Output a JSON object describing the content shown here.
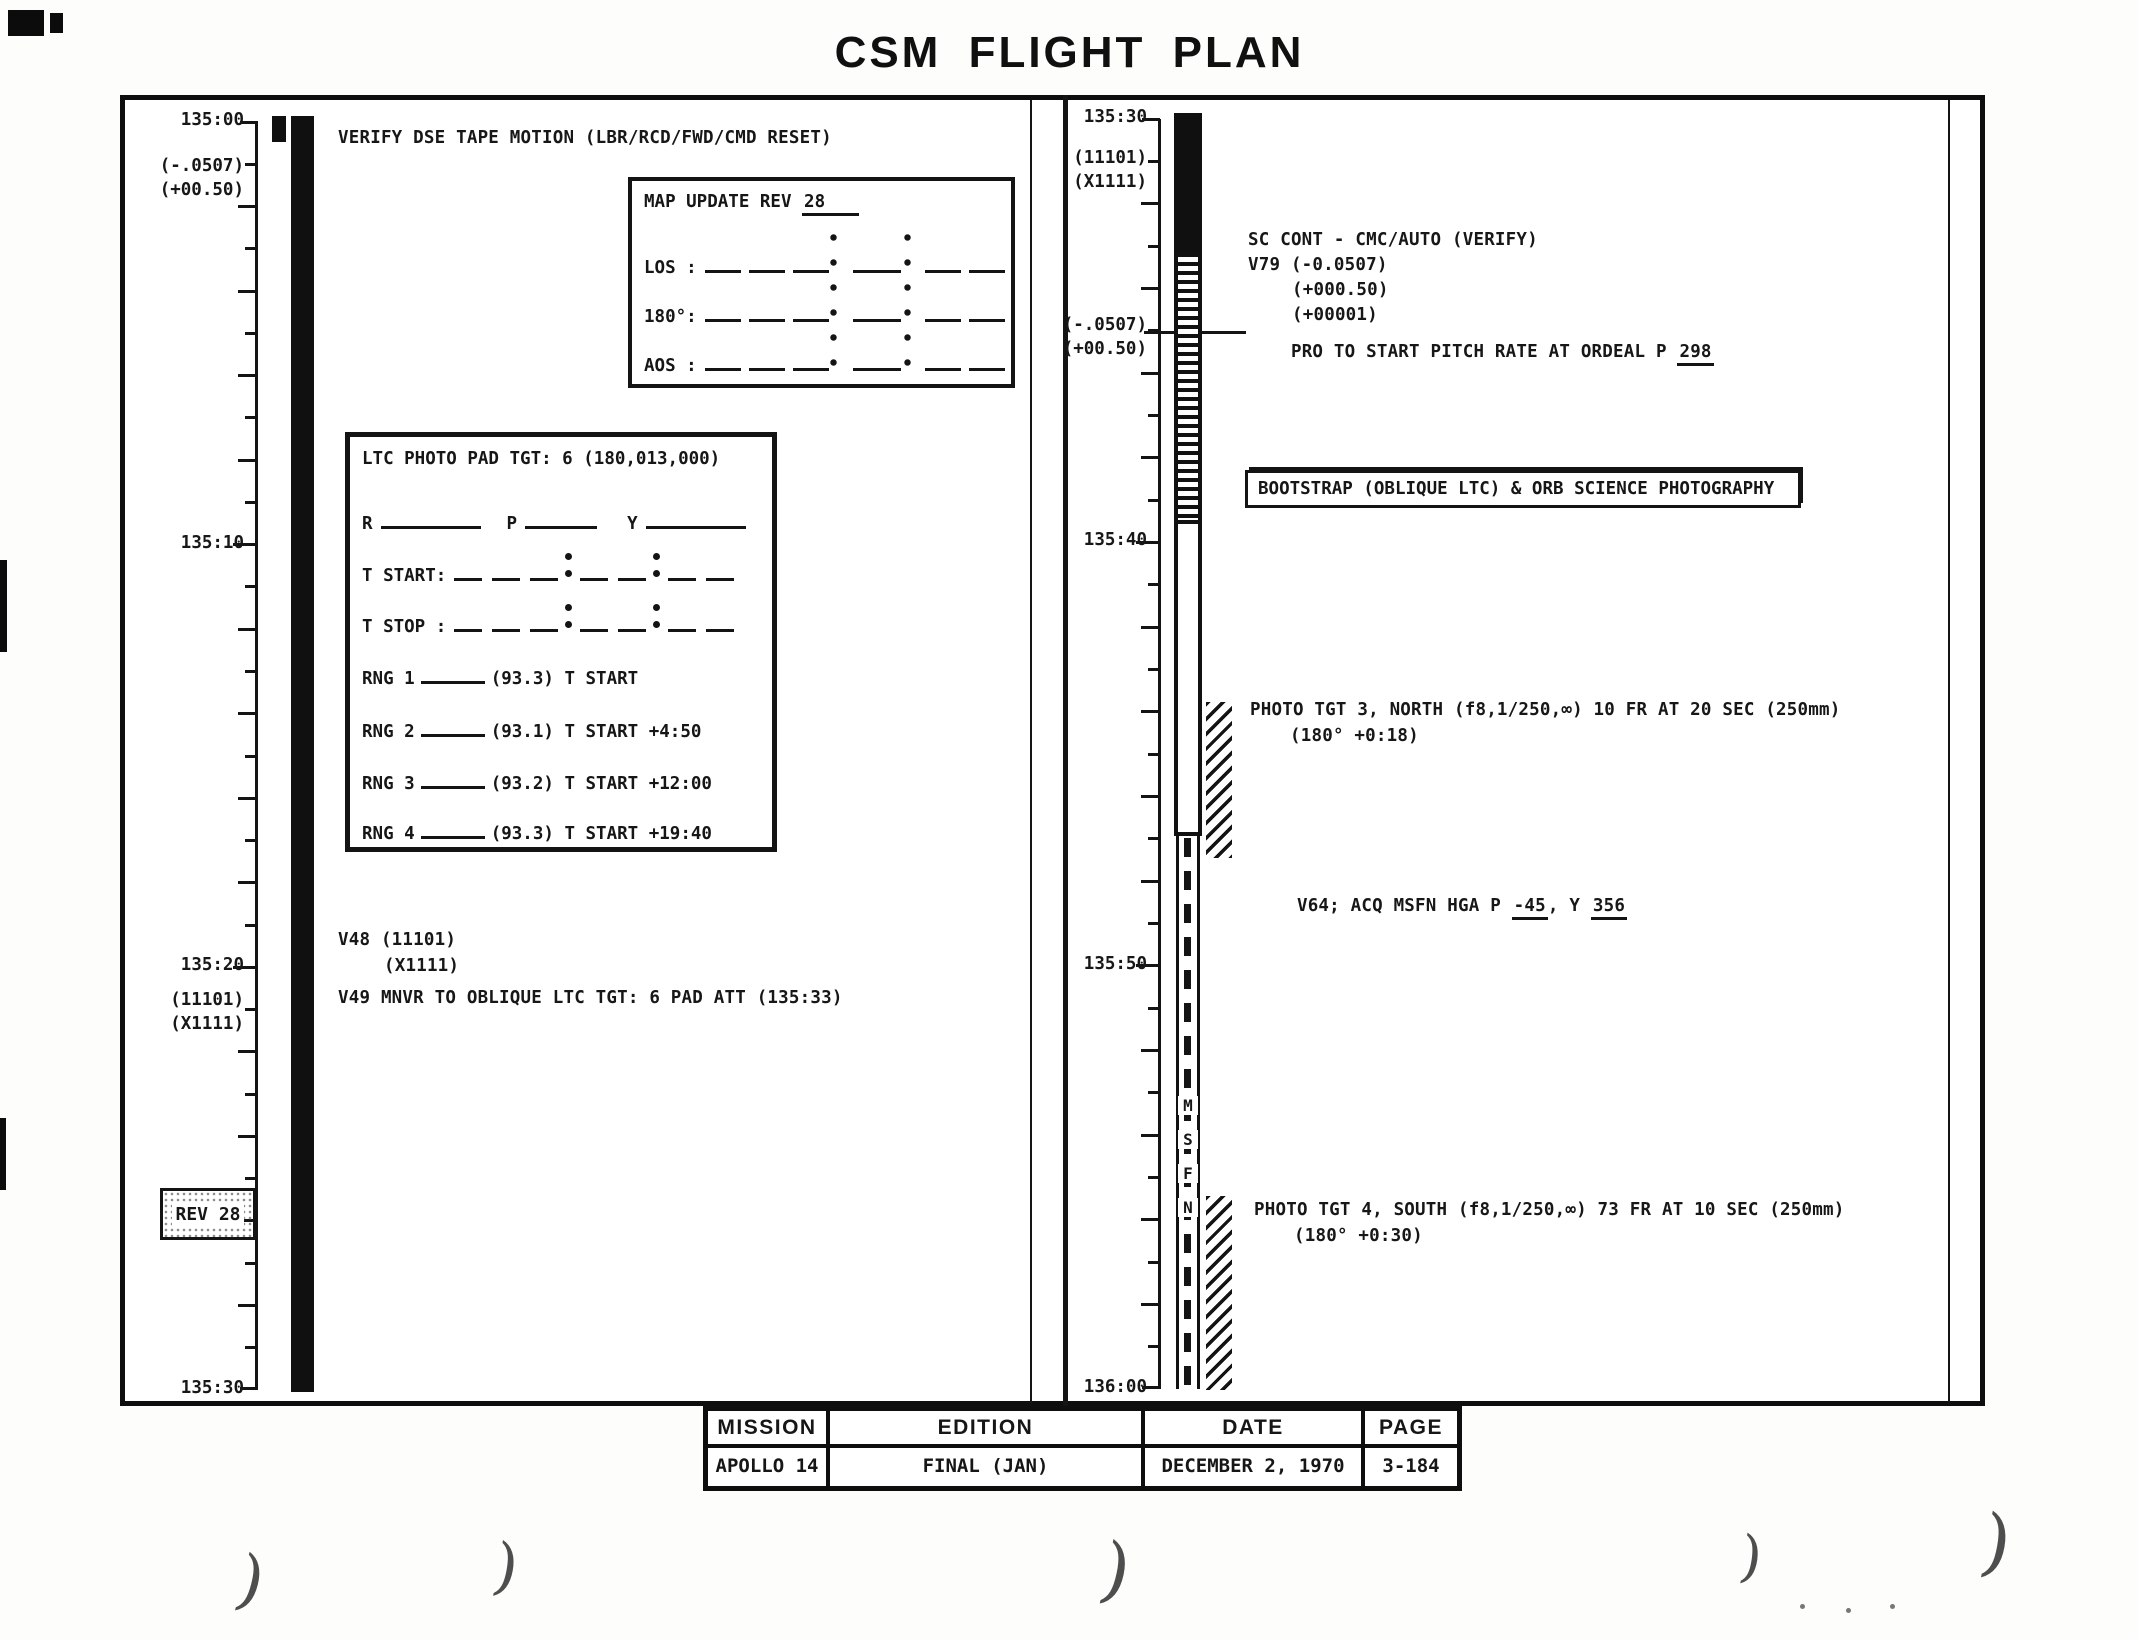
{
  "title": "CSM FLIGHT PLAN",
  "left_timeline": {
    "axis": {
      "x": 258,
      "y0": 122,
      "y1": 1390,
      "minutes": 30
    },
    "labels": [
      {
        "text": "135:00",
        "y": 122
      },
      {
        "text": "(-.0507)",
        "y": 168
      },
      {
        "text": "(+00.50)",
        "y": 192
      },
      {
        "text": "135:10",
        "y": 545
      },
      {
        "text": "135:20",
        "y": 967
      },
      {
        "text": "(11101)",
        "y": 1002
      },
      {
        "text": "(X1111)",
        "y": 1026
      },
      {
        "text": "135:30",
        "y": 1390
      }
    ],
    "rev_box_label": "REV 28"
  },
  "right_timeline": {
    "axis": {
      "x": 1161,
      "y0": 119,
      "y1": 1389,
      "minutes": 30
    },
    "labels": [
      {
        "text": "135:30",
        "y": 119
      },
      {
        "text": "(11101)",
        "y": 160
      },
      {
        "text": "(X1111)",
        "y": 184
      },
      {
        "text": "(-.0507)",
        "y": 327
      },
      {
        "text": "(+00.50)",
        "y": 351
      },
      {
        "text": "135:40",
        "y": 542
      },
      {
        "text": "135:50",
        "y": 966
      },
      {
        "text": "136:00",
        "y": 1389
      }
    ],
    "msfn": [
      "M",
      "S",
      "F",
      "N"
    ]
  },
  "left_panel": {
    "verify_line": "VERIFY DSE TAPE MOTION (LBR/RCD/FWD/CMD RESET)",
    "map_update": {
      "title_prefix": "MAP UPDATE REV ",
      "rev_value": "28",
      "row_labels": [
        "LOS :",
        "180°:",
        "AOS :"
      ]
    },
    "ltc_pad": {
      "title": "LTC PHOTO PAD TGT:  6 (180,013,000)",
      "attitude_labels": [
        "R",
        "P",
        "Y"
      ],
      "time_row_labels": [
        "T START:",
        "T STOP :"
      ],
      "rng_rows": [
        {
          "label": "RNG 1",
          "note": "(93.3) T START"
        },
        {
          "label": "RNG 2",
          "note": "(93.1) T START +4:50"
        },
        {
          "label": "RNG 3",
          "note": "(93.2) T START +12:00"
        },
        {
          "label": "RNG 4",
          "note": "(93.3) T START +19:40"
        }
      ]
    },
    "v_block": {
      "line1": "V48 (11101)",
      "line2": "(X1111)",
      "line3": "V49 MNVR TO OBLIQUE LTC TGT: 6 PAD ATT (135:33)"
    }
  },
  "right_panel": {
    "sc_block": {
      "line1": "SC CONT - CMC/AUTO (VERIFY)",
      "line2": "V79 (-0.0507)",
      "line3": "(+000.50)",
      "line4": "(+00001)"
    },
    "pro_line": {
      "prefix": "PRO TO START PITCH RATE AT ORDEAL P ",
      "value": "298"
    },
    "bootstrap_label": "BOOTSTRAP (OBLIQUE LTC) & ORB SCIENCE PHOTOGRAPHY",
    "photo_tgt3": {
      "line1": "PHOTO TGT 3, NORTH (f8,1/250,∞) 10 FR AT 20 SEC (250mm)",
      "line2": "(180° +0:18)"
    },
    "v64_line": {
      "p1": "V64; ACQ MSFN HGA P ",
      "u1": "-45",
      "p2": ", Y ",
      "u2": "356"
    },
    "photo_tgt4": {
      "line1": "PHOTO TGT 4, SOUTH (f8,1/250,∞) 73 FR AT 10 SEC (250mm)",
      "line2": "(180° +0:30)"
    }
  },
  "footer": {
    "headers": [
      "MISSION",
      "EDITION",
      "DATE",
      "PAGE"
    ],
    "values": [
      "APOLLO 14",
      "FINAL (JAN)",
      "DECEMBER 2, 1970",
      "3-184"
    ]
  },
  "artifacts": {
    "paren_glyph": ")",
    "parens": [
      {
        "x": 238,
        "y": 1548,
        "s": 66,
        "r": 14
      },
      {
        "x": 494,
        "y": 1536,
        "s": 62,
        "r": 10
      },
      {
        "x": 1102,
        "y": 1534,
        "s": 72,
        "r": 12
      },
      {
        "x": 1740,
        "y": 1530,
        "s": 56,
        "r": 8
      },
      {
        "x": 1982,
        "y": 1506,
        "s": 74,
        "r": 10
      }
    ]
  }
}
